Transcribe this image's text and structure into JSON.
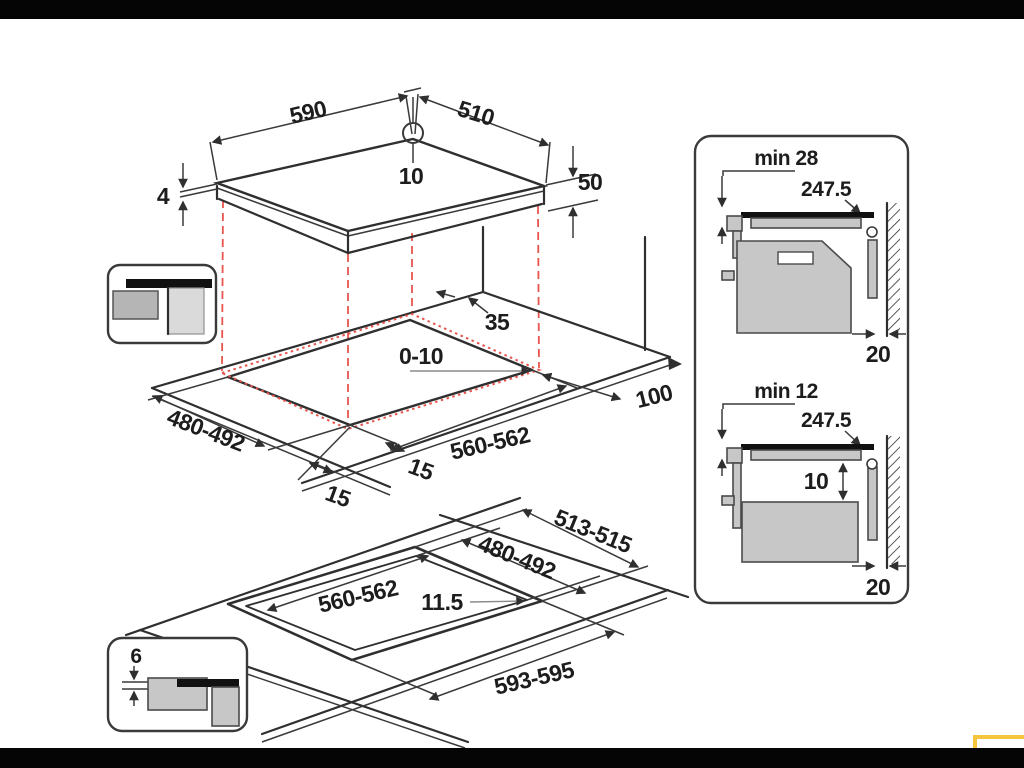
{
  "hob": {
    "width": "590",
    "depth": "510",
    "glass_thickness": "4",
    "height": "50",
    "hole_diameter": "10"
  },
  "worktop": {
    "rear_distance": "35",
    "side_gap": "0-10",
    "cutout_depth": "480-492",
    "cutout_width": "560-562",
    "front_distance_left": "15",
    "front_distance_right": "15",
    "right_wall_distance": "100"
  },
  "flush": {
    "rebate_depth": "513-515",
    "cutout_depth": "480-492",
    "cutout_width": "560-562",
    "ledge_width": "11.5",
    "rebate_width": "593-595",
    "recess_depth": "6"
  },
  "panel": {
    "top_detail": {
      "min_clearance": "min 28",
      "cable_length": "247.5",
      "wall_distance": "20"
    },
    "bottom_detail": {
      "min_clearance": "min 12",
      "cable_length": "247.5",
      "drawer_gap": "10",
      "wall_distance": "20"
    }
  },
  "colors": {
    "line": "#2f2f2f",
    "red": "#e8554e",
    "yellow": "#f4c43d",
    "black_bar": "#050505"
  }
}
